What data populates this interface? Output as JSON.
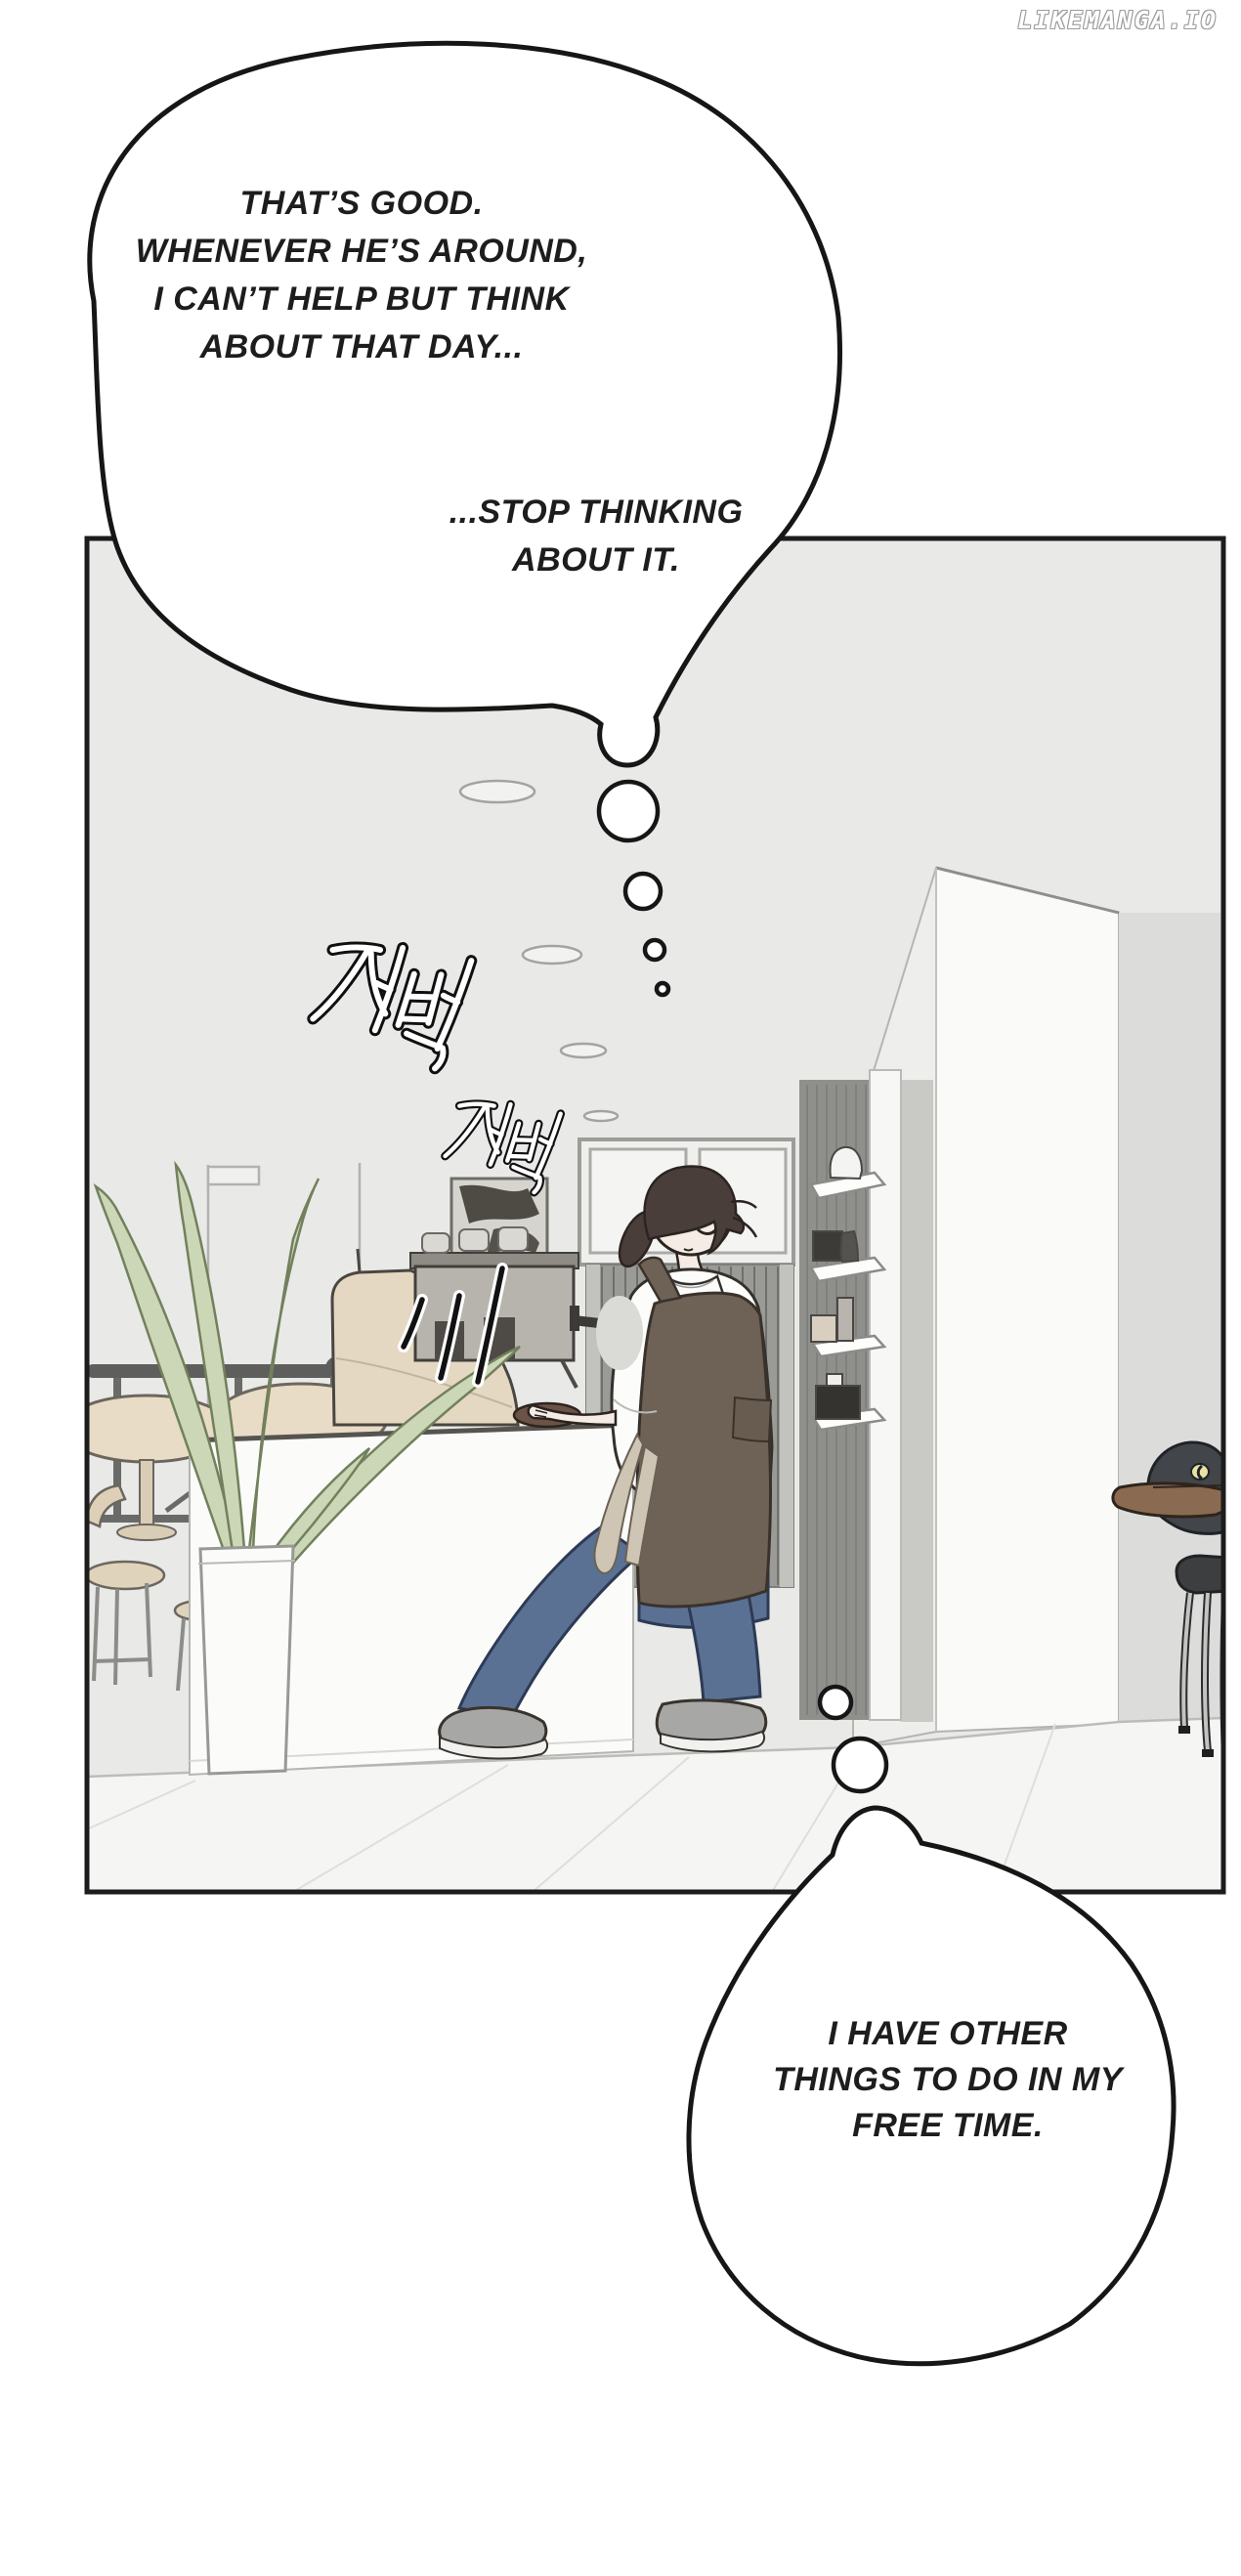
{
  "watermark": {
    "text": "LIKEMANGA.IO"
  },
  "thought_bubbles": {
    "top_main": {
      "lines": [
        "THAT’S GOOD.",
        "WHENEVER HE’S AROUND,",
        "I CAN’T HELP BUT THINK",
        "ABOUT THAT DAY..."
      ]
    },
    "top_secondary": {
      "lines": [
        "...STOP THINKING",
        "ABOUT IT."
      ]
    },
    "bottom": {
      "lines": [
        "I HAVE OTHER",
        "THINGS TO DO IN MY",
        "FREE TIME."
      ]
    }
  },
  "panel": {
    "sfx": [
      {
        "text": "저벅"
      },
      {
        "text": "저벅"
      }
    ]
  },
  "colors": {
    "line": "#1c1c1c",
    "panel_wall": "#e9e9e8",
    "floor": "#f5f5f3",
    "apron_brown": "#6e6156",
    "jeans_blue": "#5b7193",
    "plant_green": "#ccd7b7",
    "table_beige": "#e8dcc6",
    "counter_white": "#fbfbfa",
    "duck_bill_brown": "#8a6a50"
  }
}
